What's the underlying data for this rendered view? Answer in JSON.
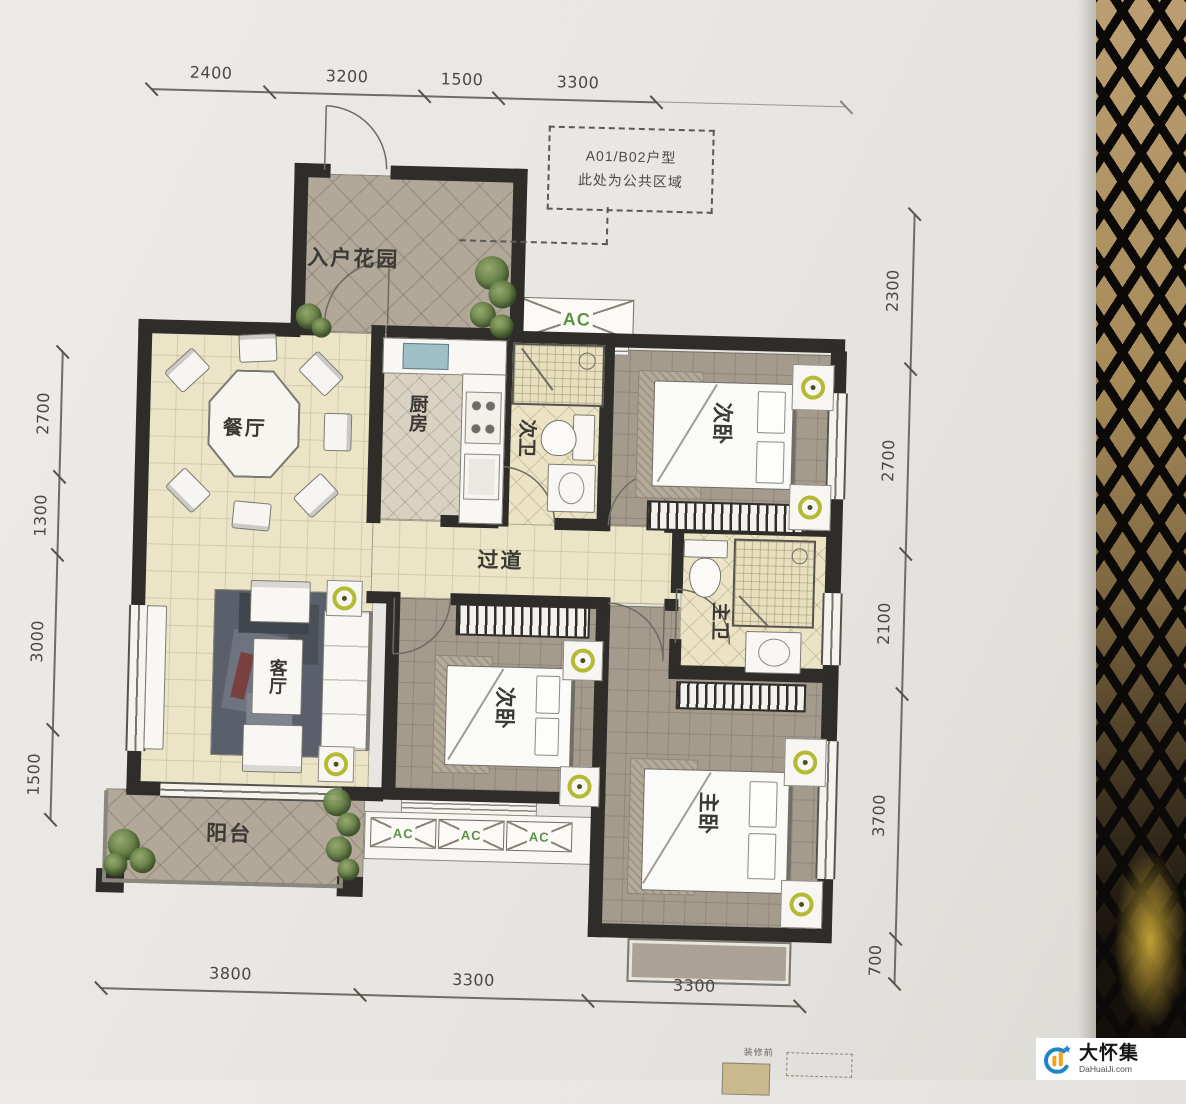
{
  "rooms": {
    "entry_garden": "入户花园",
    "dining": "餐厅",
    "kitchen": "厨房",
    "bath_secondary": "次卫",
    "bedroom_secondary_top": "次卧",
    "hallway": "过道",
    "living": "客厅",
    "bedroom_secondary_mid": "次卧",
    "bath_master": "主卫",
    "bedroom_master": "主卧",
    "balcony": "阳台"
  },
  "annotation": {
    "line1": "A01/B02户型",
    "line2": "此处为公共区域"
  },
  "ac_label": "AC",
  "dimensions": {
    "top": [
      "2400",
      "3200",
      "1500",
      "3300"
    ],
    "left": [
      "2700",
      "1300",
      "3000",
      "1500"
    ],
    "right": [
      "2300",
      "2700",
      "2100",
      "3700",
      "700"
    ],
    "bottom": [
      "3800",
      "3300",
      "3300"
    ]
  },
  "footer_note": "装修前",
  "watermark": {
    "name": "大怀集",
    "site": "DaHuaiJi.com"
  },
  "colors": {
    "wall": "#2e2d2a",
    "floor_cream": "#ece4c7",
    "floor_taupe": "#a49b8d",
    "floor_tile": "#b2a899",
    "ac_green": "#5d9147",
    "brand_blue": "#1e86c8",
    "brand_orange": "#f6a21c"
  }
}
